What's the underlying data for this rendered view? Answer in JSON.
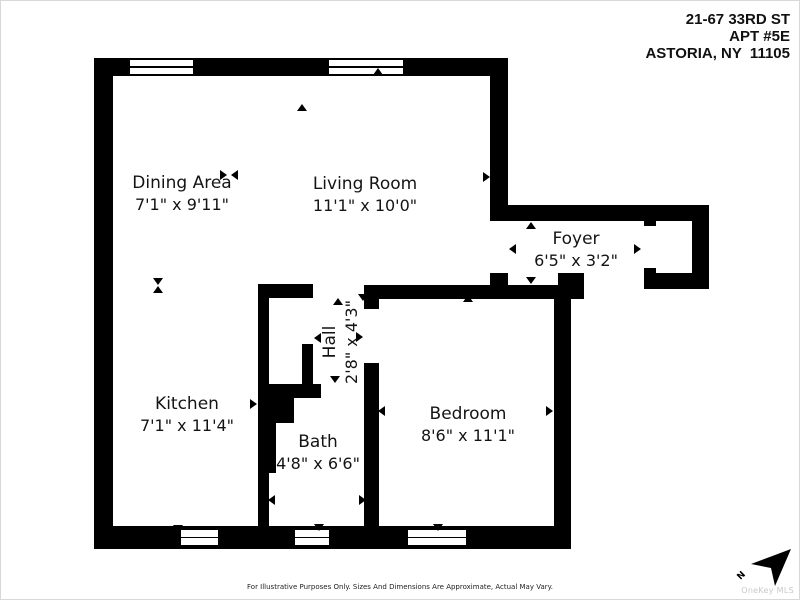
{
  "address": {
    "lines": [
      "21-67 33RD ST",
      "APT #5E",
      "ASTORIA, NY  11105"
    ]
  },
  "rooms": {
    "dining": {
      "name": "Dining Area",
      "dims": "7'1\" x 9'11\""
    },
    "living": {
      "name": "Living Room",
      "dims": "11'1\" x 10'0\""
    },
    "foyer": {
      "name": "Foyer",
      "dims": "6'5\" x 3'2\""
    },
    "hall": {
      "name": "Hall",
      "dims": "2'8\" x 4'3\""
    },
    "kitchen": {
      "name": "Kitchen",
      "dims": "7'1\" x 11'4\""
    },
    "bath": {
      "name": "Bath",
      "dims": "4'8\" x 6'6\""
    },
    "bedroom": {
      "name": "Bedroom",
      "dims": "8'6\" x 11'1\""
    }
  },
  "disclaimer": "For Illustrative Purposes Only. Sizes And Dimensions Are Approximate, Actual May Vary.",
  "compass": {
    "label": "N"
  },
  "watermark": "OneKey MLS",
  "colors": {
    "wall": "#000000",
    "text": "#141414",
    "watermark": "#c8c8c8"
  }
}
